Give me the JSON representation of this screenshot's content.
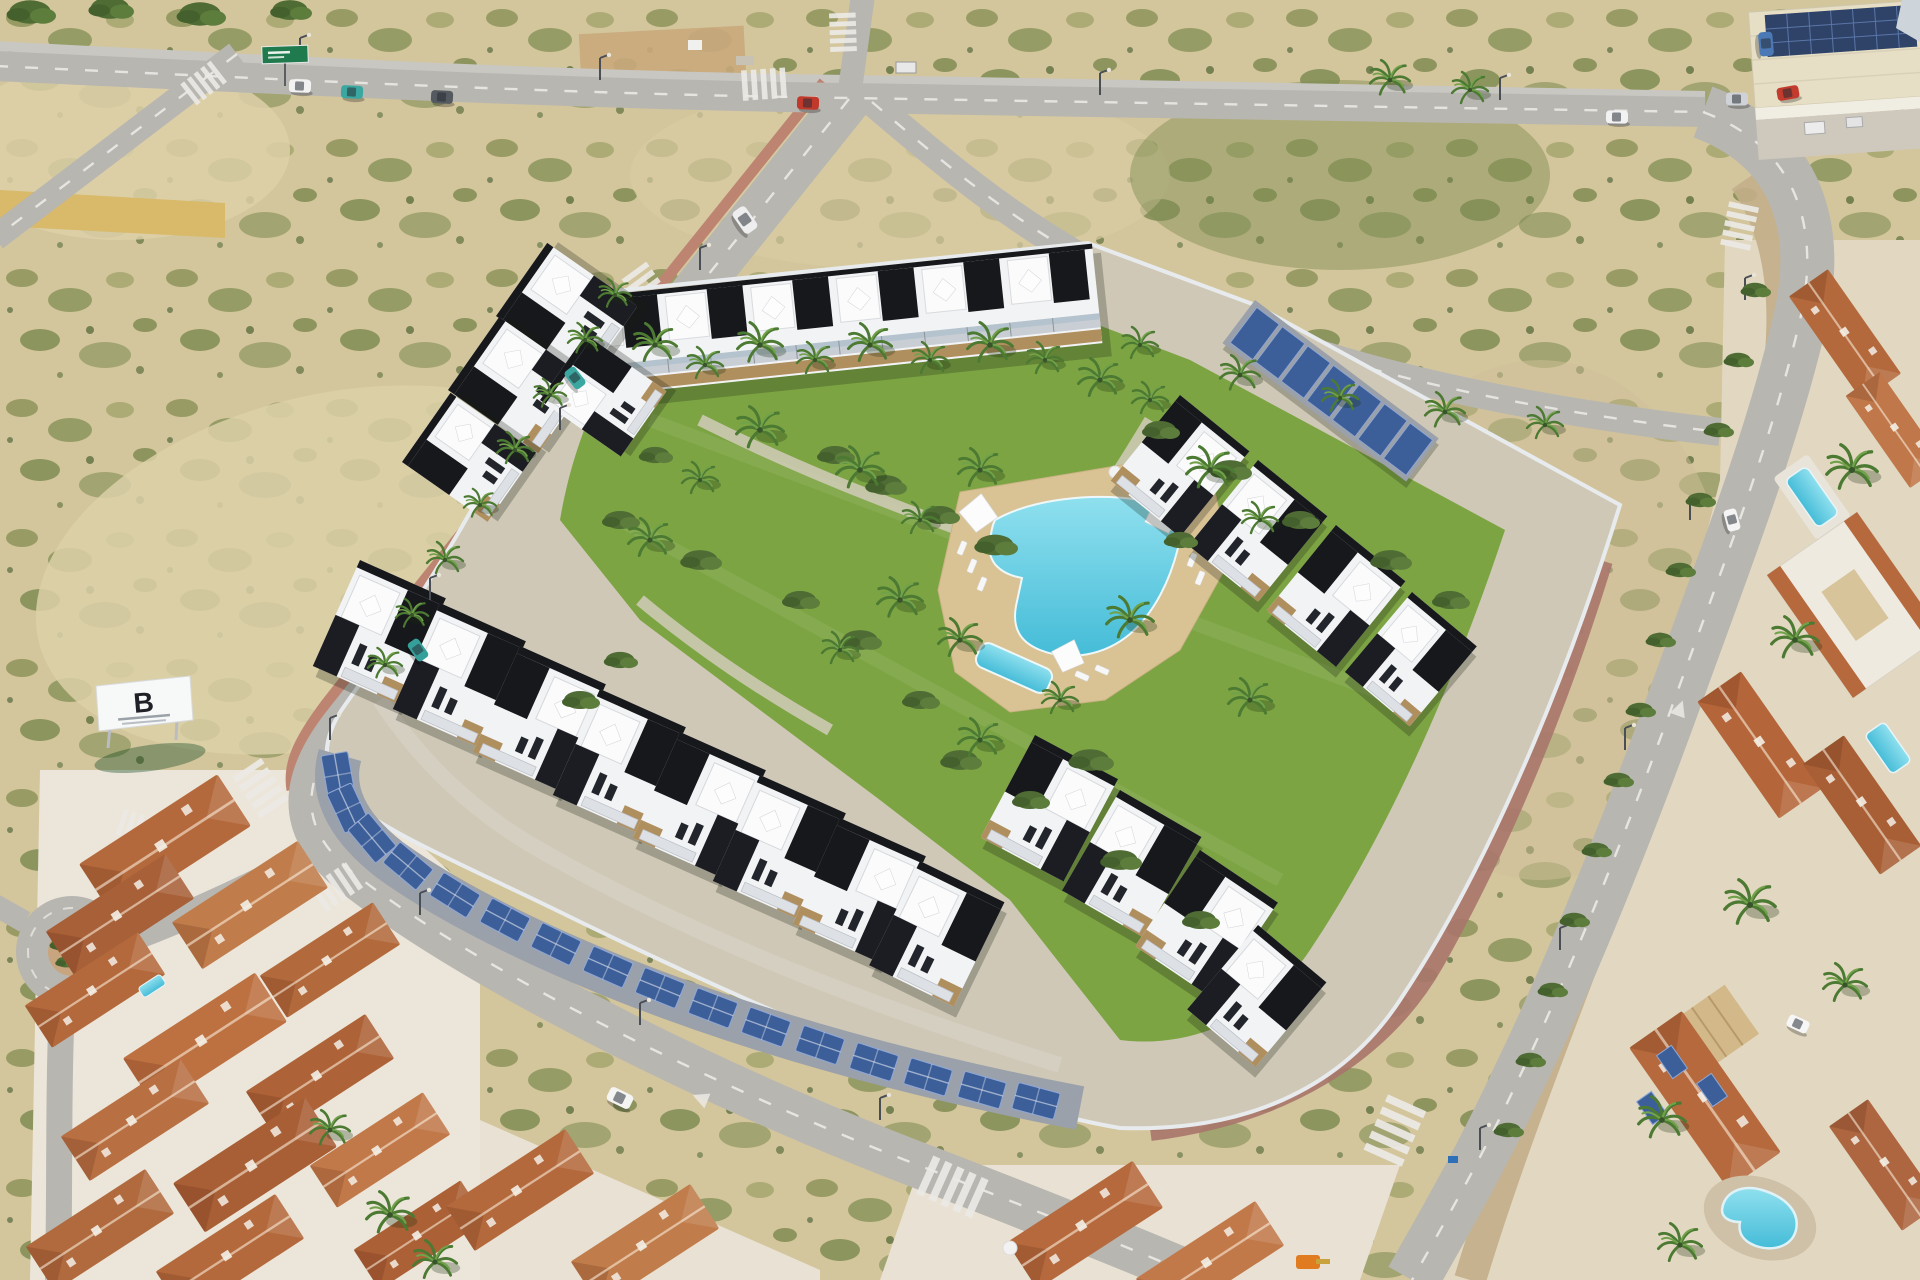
{
  "image": {
    "kind": "aerial-architectural-render",
    "subject": "Modern gated residential development with communal pool, lawns, palm trees and solar carports, surrounded by roads, empty scrubland plots, an industrial warehouse and Mediterranean terracotta-roof neighborhoods"
  },
  "billboard": {
    "logo": "B"
  },
  "palette": {
    "sand": "#d3c59c",
    "sandLight": "#ddd0a8",
    "scrub": "#7c8a4e",
    "road": "#b8b6b1",
    "sidewalkRed": "#bd8472",
    "lawn": "#7ca443",
    "lawnDark": "#6b9339",
    "poolWater": "#45bcd8",
    "poolWaterLight": "#8fe0ee",
    "poolDeck": "#d9c395",
    "building": "#f2f3f4",
    "buildingBlack": "#17181c",
    "stone": "#b08f5f",
    "wall": "#e4e7ea",
    "terracotta": "#b4693c",
    "terracottaLight": "#c8824e",
    "solar": "#3d5f99",
    "carportRoof": "#9aa1ab",
    "industrialRoof": "#e6dfc6",
    "bush": "#4e6c34",
    "signGreen": "#1f7a4d"
  }
}
